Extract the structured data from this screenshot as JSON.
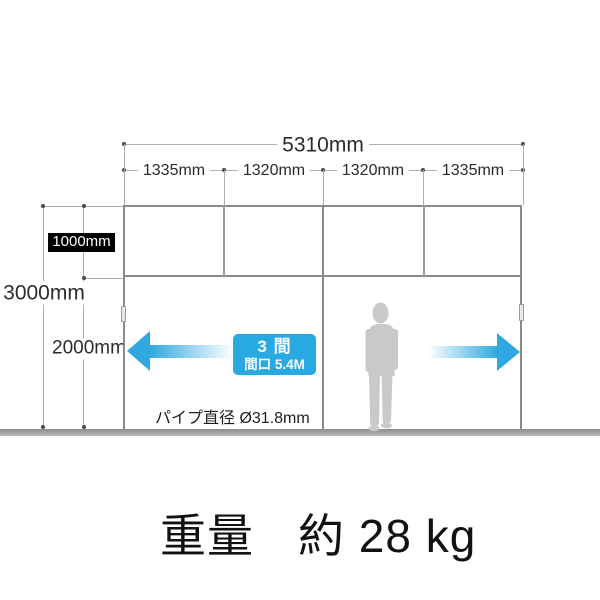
{
  "diagram": {
    "title_context": "pipe frame dimension diagram",
    "width": {
      "total_label": "5310mm",
      "segments": [
        "1335mm",
        "1320mm",
        "1320mm",
        "1335mm"
      ]
    },
    "height": {
      "total_label": "3000mm",
      "upper_label": "1000mm",
      "lower_label": "2000mm"
    },
    "span_badge": {
      "line1": "3 間",
      "line2": "間口 5.4M"
    },
    "pipe_note": "パイプ直径 Ø31.8mm",
    "colors": {
      "arrow_blue": "#2fa8e0",
      "badge_blue": "#29a9e1",
      "frame_gray": "#8a8a8a",
      "dimension_line_gray": "#b0b0ae",
      "ground_gray": "#8d8d8b",
      "person_gray": "#c9c9c9",
      "highlight_box_black": "#000000"
    }
  },
  "footer": {
    "weight_label": "重量",
    "weight_value": "約 28 kg"
  }
}
